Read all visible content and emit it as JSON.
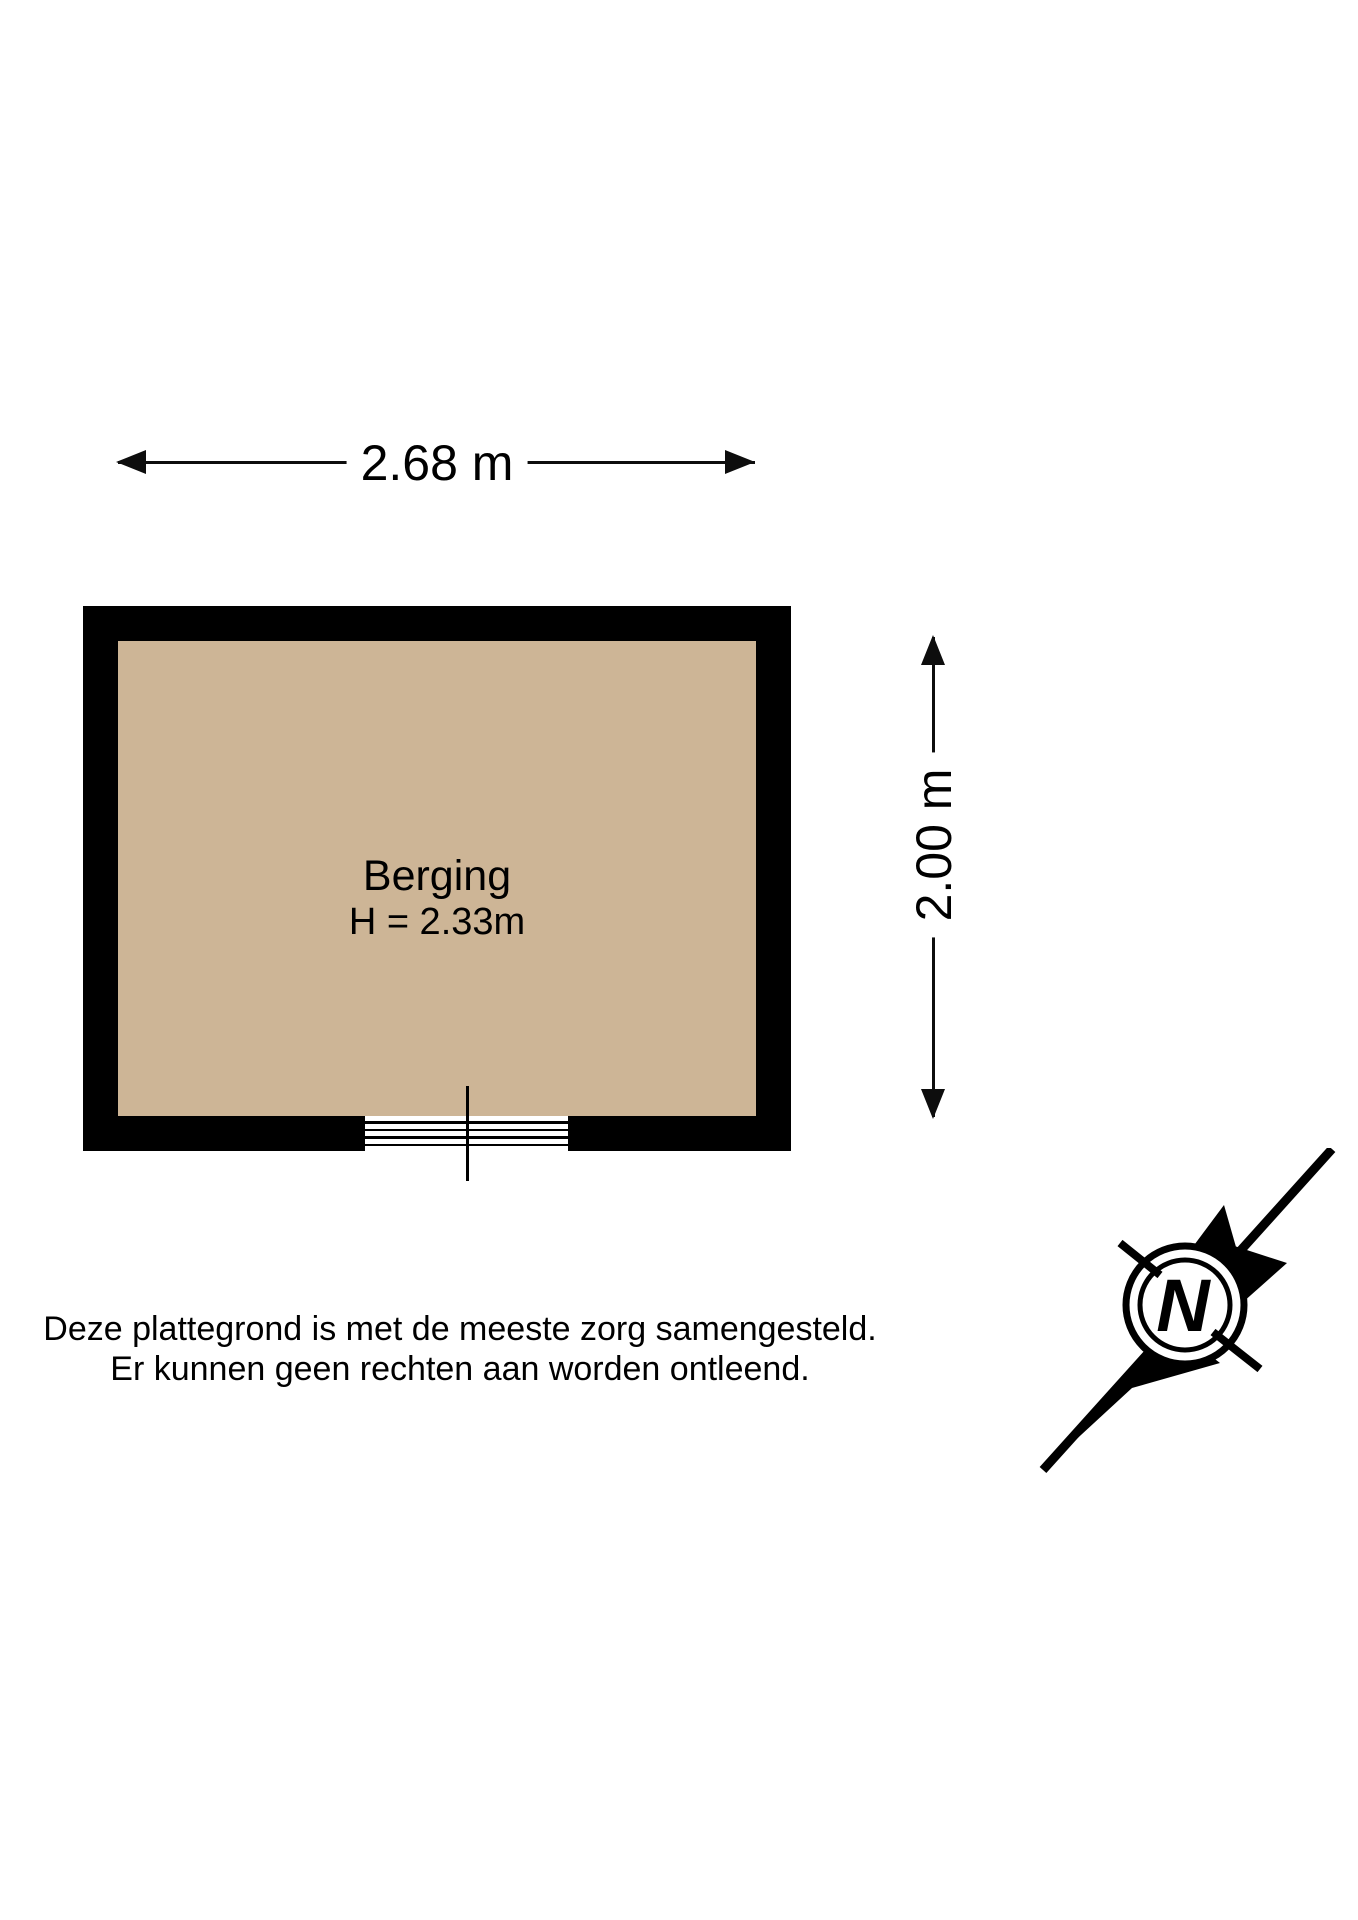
{
  "floorplan": {
    "room": {
      "name": "Berging",
      "ceiling_height_label": "H = 2.33m",
      "floor_color": "#cdb596",
      "wall_color": "#000000"
    },
    "dimensions": {
      "width_label": "2.68 m",
      "height_label": "2.00 m"
    },
    "disclaimer": {
      "line1": "Deze plattegrond is met de meeste zorg samengesteld.",
      "line2": "Er kunnen geen rechten aan worden ontleend."
    },
    "compass": {
      "north_label": "N"
    }
  }
}
